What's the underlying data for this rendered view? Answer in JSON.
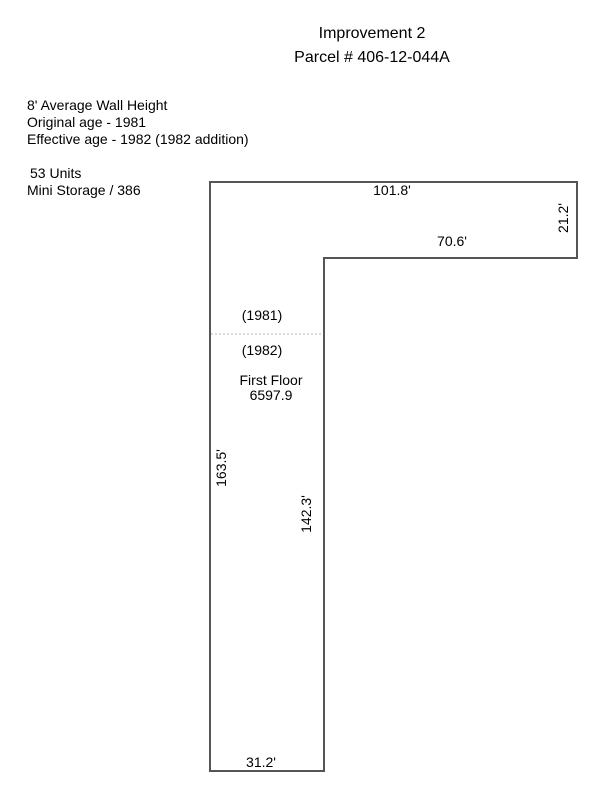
{
  "header": {
    "title": "Improvement 2",
    "subtitle": "Parcel # 406-12-044A"
  },
  "info": {
    "wall_height": "8' Average Wall Height",
    "original_age": "Original age - 1981",
    "effective_age": "Effective age - 1982 (1982 addition)",
    "unit_count": "53 Units",
    "use_code": "Mini Storage / 386"
  },
  "sketch": {
    "labels": {
      "year_upper": "(1981)",
      "year_lower": "(1982)",
      "floor_name": "First Floor",
      "floor_area": "6597.9"
    },
    "dimensions": {
      "top_edge": "101.8'",
      "right_edge": "21.2'",
      "notch_edge": "70.6'",
      "left_edge": "163.5'",
      "inner_edge": "142.3'",
      "bottom_edge": "31.2'"
    },
    "colors": {
      "outline": "#555555",
      "divider": "#b5b5b5",
      "text": "#000000",
      "background": "#ffffff"
    }
  }
}
